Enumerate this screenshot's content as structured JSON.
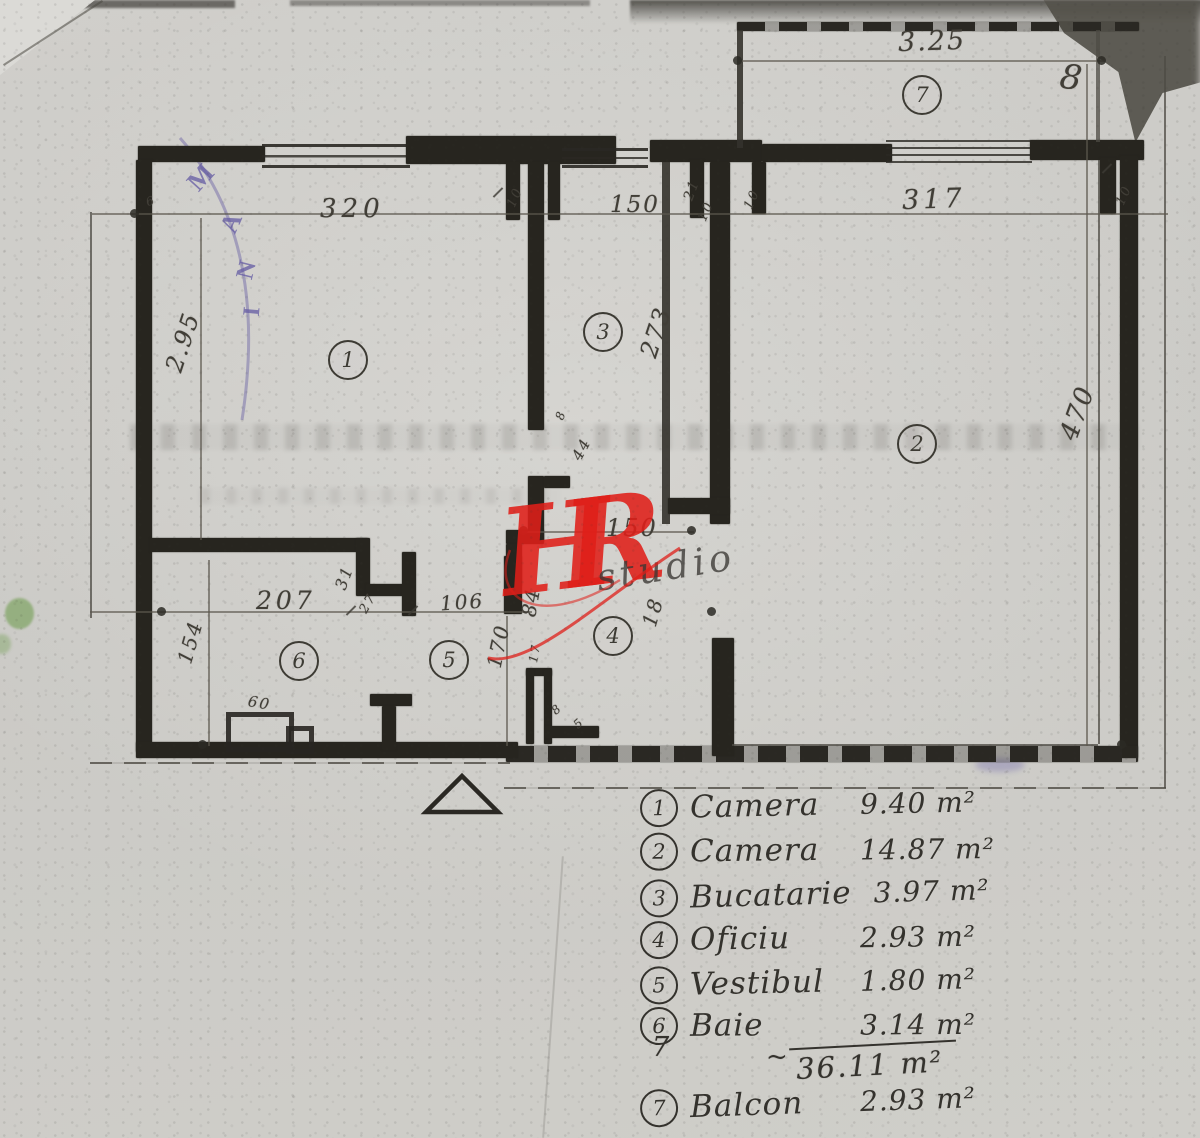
{
  "watermark": {
    "main": "HR",
    "sub": "studio",
    "color": "#df1f19"
  },
  "stamp": {
    "letters": [
      "M",
      "A",
      "N",
      "I"
    ],
    "color": "#685fa4"
  },
  "plan": {
    "rooms": [
      {
        "num": "1"
      },
      {
        "num": "2"
      },
      {
        "num": "3"
      },
      {
        "num": "4"
      },
      {
        "num": "5"
      },
      {
        "num": "6"
      },
      {
        "num": "7"
      }
    ],
    "dimensions": {
      "top_balcony": "3.25",
      "top_left": "320",
      "top_mid": "150",
      "top_right": "317",
      "left_v": "2.95",
      "kitchen_v": "273",
      "right_v": "470",
      "mid_h": "150",
      "bottom_left": "207",
      "bottom_small": "27",
      "bottom_mid": "106",
      "baie_v": "154",
      "vestibul_v": "170",
      "w84": "84",
      "w18": "18",
      "w31": "31",
      "w44": "44",
      "w60": "60",
      "w17": "17",
      "w21": "21",
      "t10a": "10",
      "t10b": "10",
      "t10c": "10",
      "t10d": "10",
      "t6": "6",
      "s8a": "8",
      "s8b": "8",
      "s5": "5",
      "hand8": "8"
    }
  },
  "legend": {
    "items": [
      {
        "num": "1",
        "name": "Camera",
        "area": "9.40 m²"
      },
      {
        "num": "2",
        "name": "Camera",
        "area": "14.87 m²"
      },
      {
        "num": "3",
        "name": "Bucatarie",
        "area": "3.97 m²"
      },
      {
        "num": "4",
        "name": "Oficiu",
        "area": "2.93 m²"
      },
      {
        "num": "5",
        "name": "Vestibul",
        "area": "1.80 m²"
      },
      {
        "num": "6",
        "name": "Baie",
        "area": "3.14 m²"
      }
    ],
    "total_marker": "7",
    "total_tilde": "~",
    "total": "36.11 m²",
    "balcony": {
      "num": "7",
      "name": "Balcon",
      "area": "2.93 m²"
    }
  }
}
